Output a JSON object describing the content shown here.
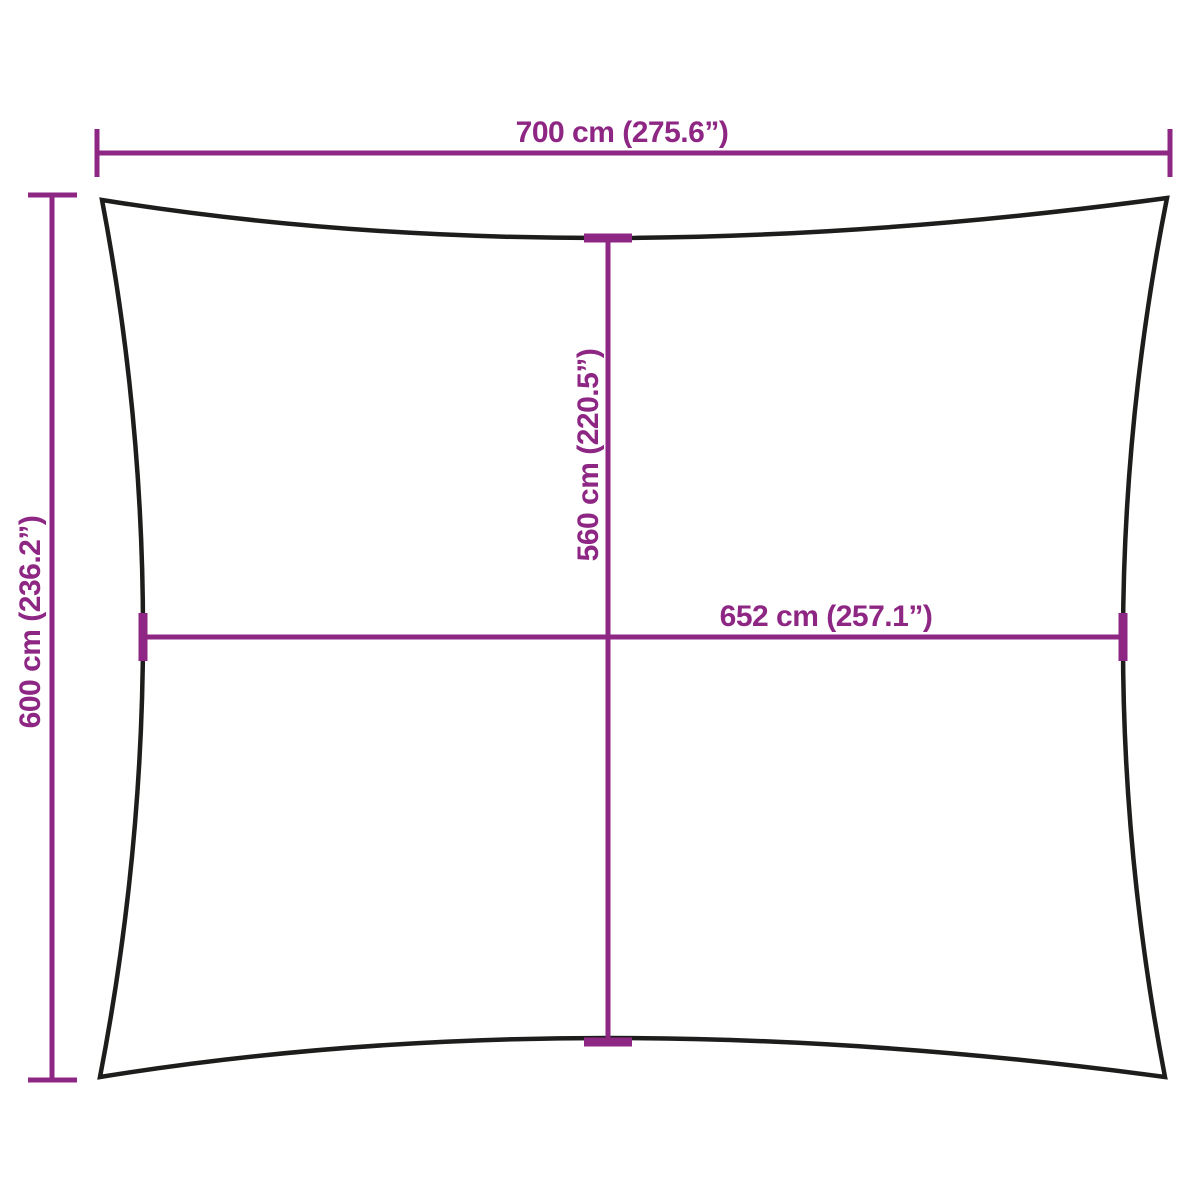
{
  "diagram": {
    "type": "product-dimension-diagram",
    "subject": "rectangular shade sail with concave edges",
    "colors": {
      "dimension": "#8e2683",
      "outline": "#1d1d1b",
      "background": "#ffffff"
    },
    "measurements": {
      "overall_width": {
        "cm": "700",
        "inches": "275.6",
        "label": "700 cm (275.6”)"
      },
      "overall_height": {
        "cm": "600",
        "inches": "236.2",
        "label": "600 cm (236.2”)"
      },
      "inner_height": {
        "cm": "560",
        "inches": "220.5",
        "label": "560 cm (220.5”)"
      },
      "inner_width": {
        "cm": "652",
        "inches": "257.1",
        "label": "652 cm (257.1”)"
      }
    }
  }
}
